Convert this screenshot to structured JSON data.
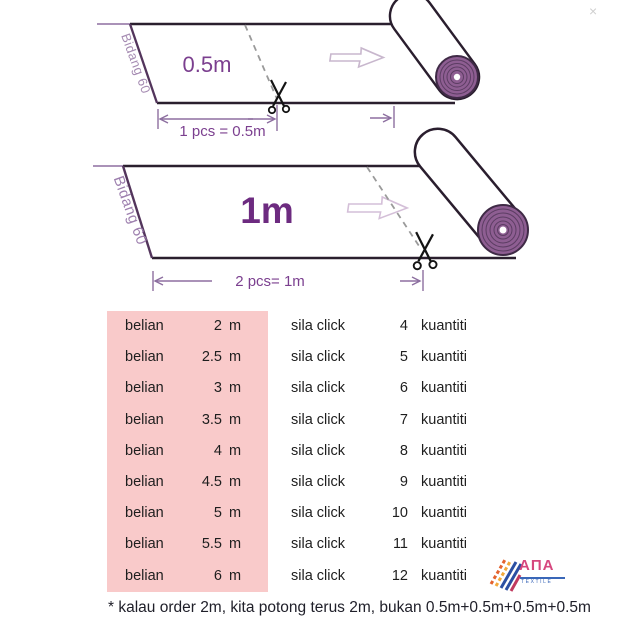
{
  "colors": {
    "pink_highlight": "#f9caca",
    "purple_label": "#7b3f8f",
    "roll_fill": "#8e5e92",
    "edge_dark": "#2a1f2e",
    "logo_pink": "#d6477e",
    "logo_blue": "#2b4fa2"
  },
  "close_label": "×",
  "diagram_top": {
    "bidang_label": "Bidang 60",
    "size_label": "0.5m",
    "dimension_label": "1 pcs = 0.5m"
  },
  "diagram_bottom": {
    "bidang_label": "Bidang 60",
    "size_label": "1m",
    "dimension_label": "2 pcs= 1m"
  },
  "table": {
    "rows": [
      {
        "buy": "belian",
        "length": "2",
        "unit": "m",
        "action": "sila click",
        "qty": "4",
        "qty_unit": "kuantiti"
      },
      {
        "buy": "belian",
        "length": "2.5",
        "unit": "m",
        "action": "sila click",
        "qty": "5",
        "qty_unit": "kuantiti"
      },
      {
        "buy": "belian",
        "length": "3",
        "unit": "m",
        "action": "sila click",
        "qty": "6",
        "qty_unit": "kuantiti"
      },
      {
        "buy": "belian",
        "length": "3.5",
        "unit": "m",
        "action": "sila click",
        "qty": "7",
        "qty_unit": "kuantiti"
      },
      {
        "buy": "belian",
        "length": "4",
        "unit": "m",
        "action": "sila click",
        "qty": "8",
        "qty_unit": "kuantiti"
      },
      {
        "buy": "belian",
        "length": "4.5",
        "unit": "m",
        "action": "sila click",
        "qty": "9",
        "qty_unit": "kuantiti"
      },
      {
        "buy": "belian",
        "length": "5",
        "unit": "m",
        "action": "sila click",
        "qty": "10",
        "qty_unit": "kuantiti"
      },
      {
        "buy": "belian",
        "length": "5.5",
        "unit": "m",
        "action": "sila click",
        "qty": "11",
        "qty_unit": "kuantiti"
      },
      {
        "buy": "belian",
        "length": "6",
        "unit": "m",
        "action": "sila click",
        "qty": "12",
        "qty_unit": "kuantiti"
      }
    ]
  },
  "footnote": "* kalau order 2m, kita potong terus 2m, bukan 0.5m+0.5m+0.5m+0.5m",
  "logo": {
    "name": "AΠA",
    "subtitle": "TEXTILE"
  }
}
